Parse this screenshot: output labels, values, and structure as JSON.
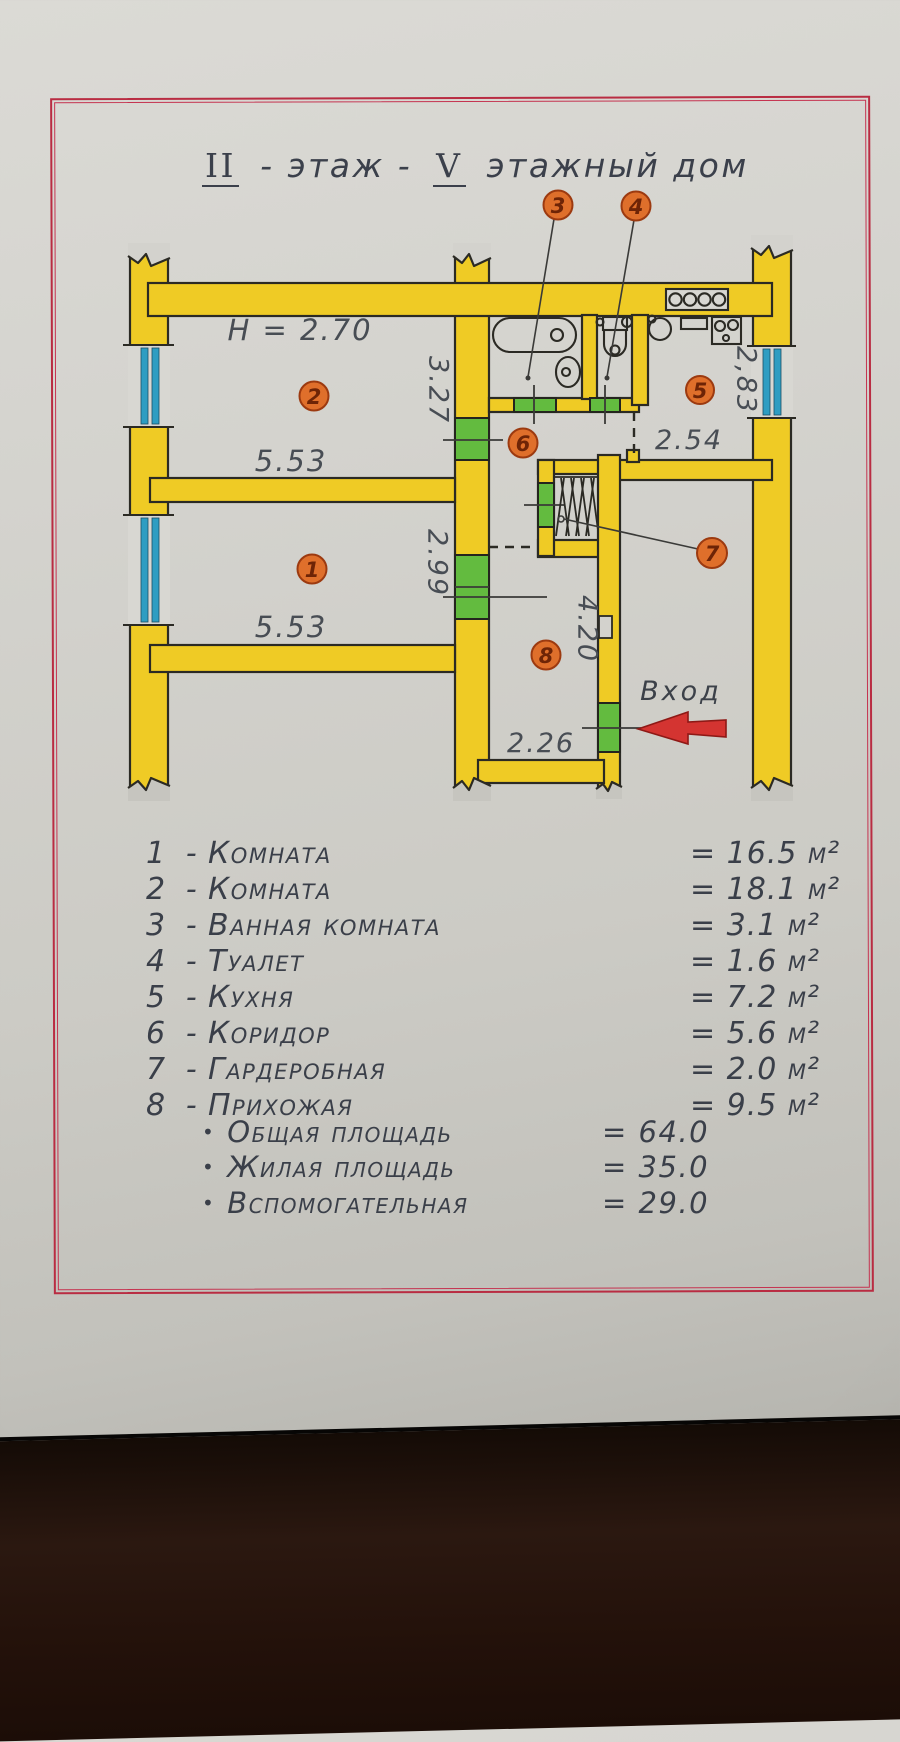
{
  "title": {
    "floor_roman": "II",
    "mid": "- этаж -",
    "building_roman": "V",
    "rest": "этажный дом"
  },
  "plan": {
    "ceiling_height": "H = 2.70",
    "entrance": "Вход",
    "dims": {
      "room2_width": "5.53",
      "room2_depth": "3.27",
      "room1_width": "5.53",
      "room1_depth": "2.99",
      "kitchen_depth": "2,83",
      "kitchen_width": "2.54",
      "hall_depth": "4.20",
      "hall_width": "2.26"
    },
    "badges": {
      "n1": "1",
      "n2": "2",
      "n3": "3",
      "n4": "4",
      "n5": "5",
      "n6": "6",
      "n7": "7",
      "n8": "8"
    },
    "colors": {
      "wall_yellow": "#efcb25",
      "door_green": "#63bb3f",
      "window_blue": "#2e9dc2",
      "badge_orange": "#df6f2b",
      "arrow_red": "#d43431",
      "border_red": "#b92c42"
    }
  },
  "legend": {
    "separator": "-",
    "bullet": "•",
    "rows": [
      {
        "num": "1",
        "name": "Комната",
        "area": "= 16.5 м²"
      },
      {
        "num": "2",
        "name": "Комната",
        "area": "= 18.1 м²"
      },
      {
        "num": "3",
        "name": "Ванная комната",
        "area": "= 3.1 м²"
      },
      {
        "num": "4",
        "name": "Туалет",
        "area": "= 1.6 м²"
      },
      {
        "num": "5",
        "name": "Кухня",
        "area": "= 7.2 м²"
      },
      {
        "num": "6",
        "name": "Коридор",
        "area": "= 5.6 м²"
      },
      {
        "num": "7",
        "name": "Гардеробная",
        "area": "= 2.0 м²"
      },
      {
        "num": "8",
        "name": "Прихожая",
        "area": "= 9.5 м²"
      }
    ],
    "totals": [
      {
        "label": "Общая площадь",
        "value": "= 64.0"
      },
      {
        "label": "Жилая площадь",
        "value": "= 35.0"
      },
      {
        "label": "Вспомогательная",
        "value": "= 29.0"
      }
    ]
  }
}
